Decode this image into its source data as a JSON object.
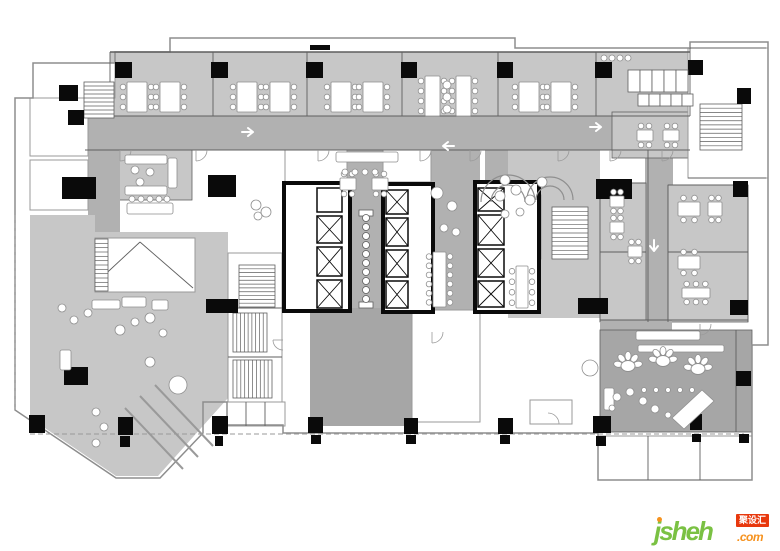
{
  "palette": {
    "white": "#ffffff",
    "black": "#0a0a0a",
    "room": "#c7c7c7",
    "corr": "#b1b1b1",
    "dark": "#a6a6a6",
    "wall": "#5f5f5f",
    "wall_light": "#9a9a9a",
    "outer": "#8d8d8d",
    "furn": "#8f8f8f",
    "arrow": "#ffffff"
  },
  "watermark": {
    "name": "jsheh",
    "tld": ".com",
    "badge": "聚设汇",
    "name_color": "#7ac143",
    "tld_color": "#f6921e",
    "dot_color": "#f6921e",
    "badge_bg": "#e8380d",
    "badge_text_color": "#ffffff"
  },
  "floorplan": {
    "zones": [
      {
        "f": "room",
        "x": 110,
        "y": 52,
        "w": 580,
        "h": 64
      },
      {
        "f": "room",
        "x": 118,
        "y": 148,
        "w": 74,
        "h": 52,
        "s": 1
      },
      {
        "f": "room",
        "x": 322,
        "y": 148,
        "w": 98,
        "h": 60,
        "s": 1
      },
      {
        "f": "corr",
        "x": 85,
        "y": 116,
        "w": 606,
        "h": 34
      },
      {
        "f": "corr",
        "x": 88,
        "y": 148,
        "w": 32,
        "h": 84
      },
      {
        "f": "corr",
        "x": 347,
        "y": 148,
        "w": 38,
        "h": 172
      },
      {
        "f": "corr",
        "x": 428,
        "y": 148,
        "w": 52,
        "h": 170
      },
      {
        "f": "corr",
        "x": 485,
        "y": 148,
        "w": 86,
        "h": 56
      },
      {
        "f": "room",
        "x": 508,
        "y": 150,
        "w": 92,
        "h": 168
      },
      {
        "f": "corr",
        "x": 645,
        "y": 150,
        "w": 28,
        "h": 172
      },
      {
        "f": "room",
        "x": 600,
        "y": 183,
        "w": 46,
        "h": 139,
        "s": 1
      },
      {
        "f": "room",
        "x": 668,
        "y": 185,
        "w": 80,
        "h": 137,
        "s": 1
      },
      {
        "f": "room",
        "x": 612,
        "y": 112,
        "w": 78,
        "h": 46,
        "s": 1
      },
      {
        "f": "corr",
        "x": 600,
        "y": 320,
        "w": 72,
        "h": 26
      },
      {
        "f": "dark",
        "x": 600,
        "y": 330,
        "w": 152,
        "h": 102,
        "s": 1
      },
      {
        "f": "dark",
        "x": 310,
        "y": 308,
        "w": 102,
        "h": 118
      },
      {
        "f": "room",
        "pts": "30,215 95,215 95,232 228,232 228,398 158,476 116,476 30,418"
      }
    ],
    "white_rooms": [
      [
        33,
        63,
        82,
        35
      ],
      [
        30,
        98,
        58,
        58
      ],
      [
        30,
        160,
        58,
        50
      ],
      [
        228,
        253,
        54,
        149
      ],
      [
        227,
        402,
        58,
        24
      ],
      [
        285,
        150,
        62,
        32
      ],
      [
        383,
        150,
        48,
        32
      ],
      [
        408,
        218,
        24,
        92
      ],
      [
        412,
        310,
        68,
        112
      ],
      [
        505,
        195,
        36,
        64
      ],
      [
        598,
        436,
        154,
        44
      ],
      [
        530,
        400,
        42,
        24
      ],
      [
        688,
        48,
        80,
        130
      ],
      [
        95,
        238,
        100,
        54
      ]
    ],
    "outline": "170,38 515,38 515,48 690,48 690,42 768,42 768,345 752,345 752,480 598,480 598,433 283,433 283,425 227,425 227,402 203,402 203,433 160,478 116,478 15,410 15,98 33,98 33,63 115,63 115,52 170,52",
    "walls": [
      [
        110,
        52,
        690,
        52,
        1.6
      ],
      [
        110,
        52,
        110,
        116
      ],
      [
        213,
        52,
        213,
        116
      ],
      [
        307,
        52,
        307,
        116
      ],
      [
        402,
        52,
        402,
        116
      ],
      [
        498,
        52,
        498,
        116
      ],
      [
        596,
        52,
        596,
        116
      ],
      [
        690,
        48,
        690,
        116
      ],
      [
        110,
        116,
        690,
        116
      ],
      [
        85,
        150,
        690,
        150
      ],
      [
        600,
        183,
        600,
        322
      ],
      [
        648,
        150,
        648,
        322
      ],
      [
        668,
        185,
        668,
        322
      ],
      [
        748,
        185,
        748,
        322
      ],
      [
        600,
        183,
        646,
        183
      ],
      [
        668,
        185,
        748,
        185
      ],
      [
        668,
        252,
        748,
        252
      ],
      [
        600,
        252,
        646,
        252
      ],
      [
        600,
        320,
        748,
        320
      ],
      [
        408,
        240,
        432,
        240
      ],
      [
        408,
        262,
        432,
        262
      ],
      [
        408,
        284,
        432,
        284
      ],
      [
        246,
        402,
        246,
        426
      ],
      [
        265,
        402,
        265,
        426
      ],
      [
        228,
        308,
        282,
        308
      ],
      [
        228,
        357,
        282,
        357
      ],
      [
        648,
        436,
        648,
        480
      ],
      [
        700,
        436,
        700,
        480
      ],
      [
        736,
        330,
        736,
        432
      ],
      [
        97,
        282,
        140,
        242
      ],
      [
        140,
        242,
        193,
        288
      ],
      [
        688,
        178,
        766,
        178
      ],
      [
        690,
        48,
        766,
        48
      ],
      [
        721,
        104,
        721,
        150
      ]
    ],
    "dashed": [
      [
        30,
        434,
        744,
        434
      ],
      [
        15,
        215,
        15,
        410
      ]
    ],
    "diag_lines": [
      [
        125,
        408,
        183,
        469
      ],
      [
        140,
        396,
        198,
        457
      ],
      [
        155,
        385,
        213,
        446
      ]
    ],
    "door_arcs": [
      [
        196,
        150,
        11,
        0
      ],
      [
        318,
        150,
        11,
        0
      ],
      [
        420,
        150,
        11,
        0
      ],
      [
        470,
        150,
        11,
        0
      ],
      [
        558,
        150,
        11,
        0
      ],
      [
        610,
        150,
        11,
        0
      ],
      [
        662,
        150,
        11,
        0
      ],
      [
        700,
        324,
        11,
        0
      ],
      [
        432,
        332,
        11,
        0
      ],
      [
        548,
        424,
        11,
        270
      ],
      [
        120,
        150,
        11,
        0
      ],
      [
        283,
        340,
        10,
        90
      ]
    ],
    "cores": [
      {
        "x": 284,
        "y": 183,
        "w": 66,
        "h": 128
      },
      {
        "x": 383,
        "y": 184,
        "w": 50,
        "h": 128
      },
      {
        "x": 475,
        "y": 182,
        "w": 64,
        "h": 130
      }
    ],
    "elevators": [
      [
        317,
        188,
        25,
        24,
        0
      ],
      [
        317,
        216,
        25,
        27,
        1
      ],
      [
        317,
        247,
        25,
        29,
        1
      ],
      [
        317,
        280,
        25,
        28,
        1
      ],
      [
        386,
        190,
        22,
        24,
        1
      ],
      [
        386,
        218,
        22,
        28,
        1
      ],
      [
        386,
        250,
        22,
        27,
        1
      ],
      [
        386,
        281,
        22,
        27,
        1
      ],
      [
        478,
        188,
        26,
        23,
        1
      ],
      [
        478,
        215,
        26,
        30,
        1
      ],
      [
        478,
        249,
        26,
        28,
        1
      ],
      [
        478,
        281,
        26,
        26,
        1
      ]
    ],
    "stairs": [
      [
        84,
        82,
        30,
        36,
        "v",
        9
      ],
      [
        239,
        265,
        36,
        42,
        "v",
        11
      ],
      [
        233,
        313,
        34,
        39,
        "h",
        9
      ],
      [
        233,
        360,
        39,
        38,
        "h",
        10
      ],
      [
        505,
        200,
        30,
        54,
        "v",
        12
      ],
      [
        552,
        207,
        36,
        52,
        "v",
        12
      ],
      [
        700,
        104,
        42,
        46,
        "v",
        11
      ],
      [
        95,
        239,
        13,
        52,
        "v",
        12
      ]
    ],
    "strip": {
      "x": 366,
      "y": 218,
      "dy": 9,
      "r": 3.5,
      "n": 10,
      "caps": [
        [
          359,
          210,
          14,
          6
        ],
        [
          359,
          302,
          14,
          6
        ]
      ]
    },
    "columns": [
      [
        115,
        62,
        17,
        16
      ],
      [
        211,
        62,
        17,
        16
      ],
      [
        306,
        62,
        17,
        16
      ],
      [
        401,
        62,
        16,
        16
      ],
      [
        497,
        62,
        16,
        16
      ],
      [
        595,
        62,
        17,
        16
      ],
      [
        688,
        60,
        15,
        15
      ],
      [
        737,
        88,
        14,
        16
      ],
      [
        59,
        85,
        19,
        16
      ],
      [
        68,
        110,
        16,
        15
      ],
      [
        733,
        181,
        15,
        16
      ],
      [
        730,
        300,
        18,
        15
      ],
      [
        736,
        371,
        15,
        15
      ],
      [
        29,
        415,
        16,
        18
      ],
      [
        118,
        417,
        15,
        18
      ],
      [
        212,
        416,
        16,
        18
      ],
      [
        308,
        417,
        15,
        16
      ],
      [
        404,
        418,
        14,
        16
      ],
      [
        498,
        418,
        15,
        16
      ],
      [
        593,
        416,
        18,
        17
      ],
      [
        690,
        414,
        12,
        16
      ],
      [
        120,
        436,
        10,
        11
      ],
      [
        215,
        436,
        8,
        10
      ],
      [
        311,
        435,
        10,
        9
      ],
      [
        406,
        435,
        10,
        9
      ],
      [
        500,
        435,
        10,
        9
      ],
      [
        596,
        436,
        10,
        10
      ],
      [
        692,
        434,
        9,
        8
      ],
      [
        739,
        434,
        10,
        9
      ],
      [
        62,
        177,
        34,
        22
      ],
      [
        208,
        175,
        28,
        22
      ],
      [
        596,
        179,
        36,
        20
      ],
      [
        578,
        298,
        30,
        16
      ],
      [
        206,
        299,
        32,
        14
      ],
      [
        64,
        367,
        24,
        18
      ],
      [
        310,
        45,
        20,
        5
      ]
    ],
    "tables": [
      [
        127,
        82,
        20,
        30,
        "lr"
      ],
      [
        160,
        82,
        20,
        30,
        "lr"
      ],
      [
        237,
        82,
        20,
        30,
        "lr"
      ],
      [
        270,
        82,
        20,
        30,
        "lr"
      ],
      [
        331,
        82,
        20,
        30,
        "lr"
      ],
      [
        363,
        82,
        20,
        30,
        "lr"
      ],
      [
        425,
        76,
        15,
        40,
        "lr"
      ],
      [
        456,
        76,
        15,
        40,
        "lr"
      ],
      [
        519,
        82,
        20,
        30,
        "lr"
      ],
      [
        551,
        82,
        20,
        30,
        "lr"
      ],
      [
        340,
        178,
        16,
        12,
        "tb"
      ],
      [
        372,
        178,
        16,
        12,
        "tb"
      ],
      [
        678,
        202,
        22,
        14,
        "tb"
      ],
      [
        708,
        202,
        14,
        14,
        "tb"
      ],
      [
        678,
        256,
        22,
        13,
        "tb"
      ],
      [
        682,
        288,
        28,
        10,
        "tb"
      ],
      [
        610,
        196,
        14,
        11,
        "tb"
      ],
      [
        610,
        222,
        14,
        11,
        "tb"
      ],
      [
        628,
        246,
        14,
        11,
        "tb"
      ],
      [
        433,
        252,
        13,
        55,
        "lr"
      ],
      [
        516,
        266,
        12,
        42,
        "lr"
      ],
      [
        637,
        130,
        16,
        11,
        "tb"
      ],
      [
        663,
        130,
        16,
        11,
        "tb"
      ]
    ],
    "sofas": [
      [
        336,
        152,
        62,
        10
      ],
      [
        125,
        155,
        42,
        9
      ],
      [
        125,
        186,
        42,
        9
      ],
      [
        168,
        158,
        9,
        30
      ],
      [
        92,
        300,
        28,
        9
      ],
      [
        122,
        297,
        24,
        10
      ],
      [
        152,
        300,
        16,
        10
      ],
      [
        60,
        350,
        11,
        20
      ],
      [
        638,
        345,
        86,
        7
      ],
      [
        636,
        331,
        64,
        9
      ],
      [
        127,
        203,
        46,
        11
      ],
      [
        604,
        388,
        10,
        22
      ]
    ],
    "polys": [
      [
        672,
        418,
        702,
        390,
        714,
        401,
        684,
        429
      ]
    ],
    "arcs": [
      [
        508,
        202,
        27
      ],
      [
        508,
        202,
        17
      ],
      [
        550,
        200,
        23
      ],
      [
        550,
        200,
        14
      ]
    ],
    "rosettes": [
      [
        628,
        366
      ],
      [
        663,
        361
      ],
      [
        698,
        369
      ]
    ],
    "stall_grids": [
      {
        "x": 628,
        "y": 70,
        "cw": 12,
        "ch": 22,
        "n": 5
      },
      {
        "x": 638,
        "y": 94,
        "cw": 11,
        "ch": 12,
        "n": 5
      }
    ],
    "circles": [
      [
        62,
        308,
        4
      ],
      [
        74,
        320,
        4
      ],
      [
        88,
        313,
        4
      ],
      [
        150,
        318,
        5
      ],
      [
        163,
        333,
        4
      ],
      [
        178,
        385,
        9
      ],
      [
        96,
        412,
        4
      ],
      [
        104,
        427,
        4
      ],
      [
        96,
        443,
        4
      ],
      [
        150,
        362,
        5
      ],
      [
        120,
        330,
        5
      ],
      [
        135,
        322,
        4
      ],
      [
        132,
        199,
        3
      ],
      [
        141,
        199,
        3
      ],
      [
        150,
        199,
        3
      ],
      [
        159,
        199,
        3
      ],
      [
        167,
        199,
        3
      ],
      [
        256,
        205,
        5
      ],
      [
        266,
        212,
        5
      ],
      [
        258,
        216,
        4
      ],
      [
        437,
        193,
        6
      ],
      [
        452,
        206,
        5
      ],
      [
        444,
        228,
        4
      ],
      [
        456,
        232,
        4
      ],
      [
        500,
        196,
        5
      ],
      [
        516,
        190,
        5
      ],
      [
        530,
        200,
        5
      ],
      [
        505,
        214,
        4
      ],
      [
        520,
        212,
        4
      ],
      [
        505,
        180,
        5
      ],
      [
        542,
        182,
        5
      ],
      [
        447,
        85,
        4
      ],
      [
        447,
        97,
        4
      ],
      [
        447,
        109,
        4
      ],
      [
        604,
        58,
        3
      ],
      [
        612,
        58,
        3
      ],
      [
        620,
        58,
        3
      ],
      [
        628,
        58,
        3
      ],
      [
        617,
        397,
        4
      ],
      [
        630,
        392,
        4
      ],
      [
        643,
        401,
        4
      ],
      [
        655,
        409,
        4
      ],
      [
        668,
        415,
        3
      ],
      [
        612,
        408,
        3
      ],
      [
        590,
        368,
        8
      ],
      [
        644,
        390,
        2.5
      ],
      [
        656,
        390,
        2.5
      ],
      [
        668,
        390,
        2.5
      ],
      [
        680,
        390,
        2.5
      ],
      [
        692,
        390,
        2.5
      ],
      [
        345,
        172,
        3
      ],
      [
        355,
        172,
        3
      ],
      [
        365,
        172,
        3
      ],
      [
        375,
        172,
        3
      ],
      [
        135,
        170,
        4
      ],
      [
        150,
        172,
        4
      ],
      [
        140,
        182,
        4
      ]
    ],
    "arrows": [
      [
        249,
        132,
        0
      ],
      [
        447,
        146,
        180
      ],
      [
        597,
        127,
        0
      ],
      [
        654,
        247,
        90
      ]
    ]
  }
}
